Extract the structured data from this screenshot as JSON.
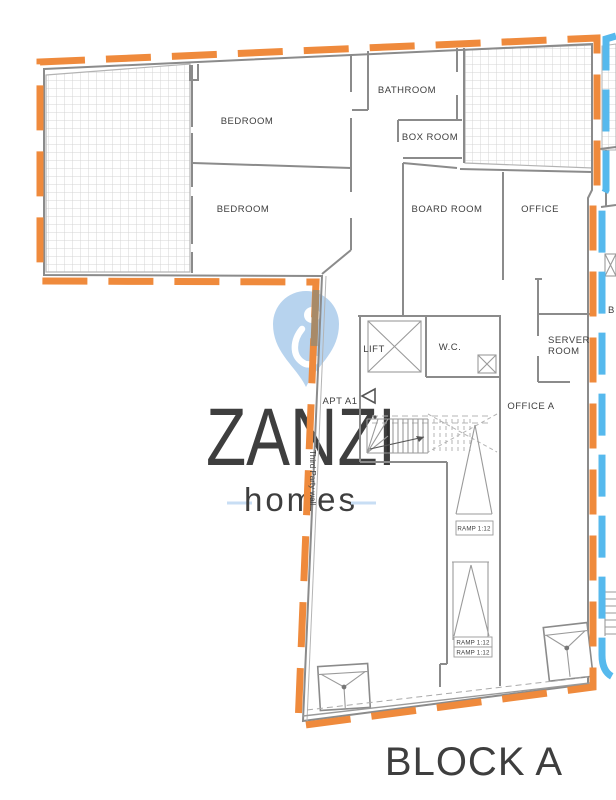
{
  "watermark": {
    "brand": "ZANZI",
    "tagline": "homes"
  },
  "plan": {
    "block_label": "BLOCK A",
    "rooms": {
      "bedroom_1": "BEDROOM",
      "bedroom_2": "BEDROOM",
      "bathroom": "BATHROOM",
      "box_room": "BOX ROOM",
      "board_room": "BOARD ROOM",
      "office": "OFFICE",
      "server_line1": "SERVER",
      "server_line2": "ROOM",
      "lift": "LIFT",
      "wc": "W.C.",
      "apt": "APT A1",
      "office_a": "OFFICE A",
      "adjacent_block_partial": "B"
    },
    "annotations": {
      "ramp_upper": "RAMP 1:12",
      "ramp_lower_1": "RAMP 1:12",
      "ramp_lower_2": "RAMP 1:12",
      "third_party_wall": "Third Party wall"
    },
    "colors": {
      "block_a": "#ef8a3c",
      "block_b": "#56b9ed",
      "party_wall": "#a88a68",
      "watermark": "#c8def4",
      "watermark_pin": "#b7d3ee"
    }
  }
}
